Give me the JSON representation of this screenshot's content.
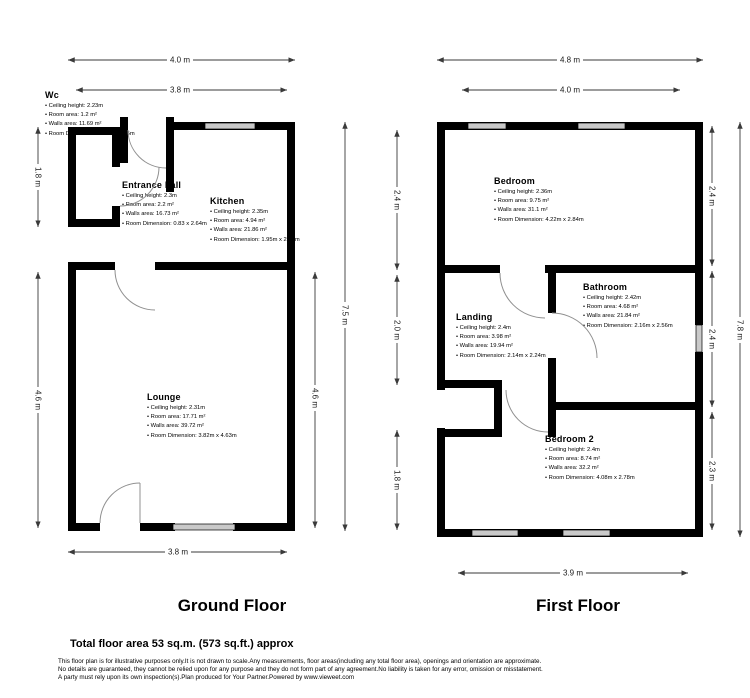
{
  "colors": {
    "wall": "#000000",
    "window_fill": "#c9c9c9",
    "door_arc": "#909090",
    "dimension_line": "#3a3a3a",
    "text": "#000000"
  },
  "floors": [
    {
      "title": "Ground Floor",
      "rooms": [
        {
          "name": "Wc",
          "details": [
            "Ceiling height: 2.23m",
            "Room area: 1.2 m²",
            "Walls area: 11.69 m²",
            "Room Dimension: 0.83m x 1.45m"
          ]
        },
        {
          "name": "Entrance hall",
          "details": [
            "Ceiling height: 2.3m",
            "Room area: 2.2 m²",
            "Walls area: 16.73 m²",
            "Room Dimension: 0.83 x 2.64m"
          ]
        },
        {
          "name": "Kitchen",
          "details": [
            "Ceiling height: 2.35m",
            "Room area: 4.94 m²",
            "Walls area: 21.86 m²",
            "Room Dimension: 1.95m x 2.53m"
          ]
        },
        {
          "name": "Lounge",
          "details": [
            "Ceiling height: 2.31m",
            "Room area: 17.71 m²",
            "Walls area: 39.72 m²",
            "Room Dimension: 3.82m x 4.63m"
          ]
        }
      ],
      "dimensions": {
        "top_outer": "4.0 m",
        "top_inner": "3.8 m",
        "left_upper": "1.8 m",
        "left_lower": "4.6 m",
        "right_inner": "4.6 m",
        "right_outer": "7.5 m",
        "bottom": "3.8 m"
      }
    },
    {
      "title": "First Floor",
      "rooms": [
        {
          "name": "Bedroom",
          "details": [
            "Ceiling height: 2.36m",
            "Room area: 9.75 m²",
            "Walls area: 31.1 m²",
            "Room Dimension: 4.22m x 2.84m"
          ]
        },
        {
          "name": "Landing",
          "details": [
            "Ceiling height: 2.4m",
            "Room area: 3.98 m²",
            "Walls area: 19.94 m²",
            "Room Dimension: 2.14m x 2.24m"
          ]
        },
        {
          "name": "Bathroom",
          "details": [
            "Ceiling height: 2.42m",
            "Room area: 4.68 m²",
            "Walls area: 21.84 m²",
            "Room Dimension: 2.16m x 2.56m"
          ]
        },
        {
          "name": "Bedroom 2",
          "details": [
            "Ceiling height: 2.4m",
            "Room area: 8.74 m²",
            "Walls area: 32.2 m²",
            "Room Dimension: 4.08m x 2.78m"
          ]
        }
      ],
      "dimensions": {
        "top_outer": "4.8 m",
        "top_inner": "4.0 m",
        "left_upper": "2.4 m",
        "left_middle": "2.0 m",
        "left_lower": "1.8 m",
        "right_upper": "2.4 m",
        "right_middle": "2.4 m",
        "right_lower": "2.3 m",
        "right_outer": "7.8 m",
        "bottom": "3.9 m"
      }
    }
  ],
  "footer": {
    "total_area": "Total floor area 53 sq.m. (573 sq.ft.) approx",
    "disclaimer_lines": [
      "This floor plan is for illustrative purposes only.It is not drawn to scale.Any measurements, floor areas(including any total floor area), openings and orientation are approximate.",
      "No details are guaranteed, they cannot be relied upon for any purpose and they do not form part of any agreement.No liability is taken for any error, omission or misstatement.",
      "A party must rely upon its own inspection(s).Plan produced for Your Partner.Powered by www.vieweet.com"
    ]
  }
}
